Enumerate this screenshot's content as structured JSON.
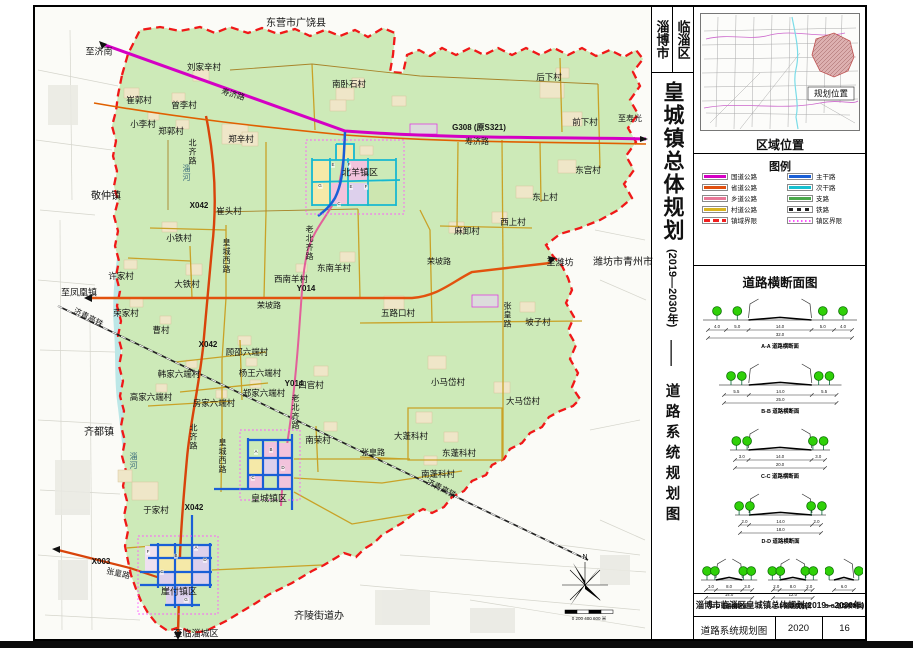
{
  "title_column": {
    "city": "淄博市",
    "district": "临淄区",
    "main": "皇城镇总体规划",
    "years": "(2019—2030年)",
    "dash": "——",
    "sub": "道路系统规划图"
  },
  "region_panel": {
    "caption": "区域位置",
    "marker": "规划位置"
  },
  "legend": {
    "title": "图例",
    "items": [
      {
        "label": "国道公路",
        "color": "#d400c4",
        "style": "solid",
        "col": 0
      },
      {
        "label": "省道公路",
        "color": "#e05010",
        "style": "solid",
        "col": 0
      },
      {
        "label": "乡道公路",
        "color": "#e87898",
        "style": "solid",
        "col": 0
      },
      {
        "label": "村道公路",
        "color": "#d9b420",
        "style": "solid",
        "col": 0
      },
      {
        "label": "镇域界限",
        "color": "#f02020",
        "style": "dash",
        "col": 0
      },
      {
        "label": "主干路",
        "color": "#1a5fd6",
        "style": "solid",
        "col": 1
      },
      {
        "label": "次干路",
        "color": "#17c0d0",
        "style": "solid",
        "col": 1
      },
      {
        "label": "支路",
        "color": "#4aa84a",
        "style": "solid",
        "col": 1
      },
      {
        "label": "铁路",
        "color": "#222222",
        "style": "rail",
        "col": 1
      },
      {
        "label": "镇区界限",
        "color": "#ff55ff",
        "style": "dot",
        "col": 1
      }
    ]
  },
  "cross_sections": {
    "title": "道路横断面图",
    "sections": [
      {
        "name": "A-A 道路横断面",
        "segments": [
          4.0,
          5.0,
          14.0,
          5.0,
          4.0
        ],
        "total": 32.0,
        "small": false
      },
      {
        "name": "B-B 道路横断面",
        "segments": [
          5.5,
          14.0,
          5.5
        ],
        "total": 25.0,
        "small": false
      },
      {
        "name": "C-C 道路横断面",
        "segments": [
          3.0,
          14.0,
          3.0
        ],
        "total": 20.0,
        "small": false
      },
      {
        "name": "D-D 道路横断面",
        "segments": [
          2.0,
          14.0,
          2.0
        ],
        "total": 18.0,
        "small": false
      },
      {
        "name": "E-E 道路横断面",
        "segments": [
          3.0,
          8.0,
          3.0
        ],
        "total": 14.0,
        "small": true
      },
      {
        "name": "F-F 道路横断面",
        "segments": [
          2.0,
          8.0,
          2.0
        ],
        "total": 12.0,
        "small": true
      },
      {
        "name": "G-G 道路横断面",
        "segments": [
          6.0
        ],
        "total": null,
        "small": true
      }
    ]
  },
  "title_block": {
    "project": "淄博市临淄区皇城镇总体规划(2019—2030年)",
    "drawing": "道路系统规划图",
    "year": "2020",
    "sheet": "16"
  },
  "map": {
    "north": "N",
    "scale": "0  200  400  600 米",
    "labels": [
      {
        "t": "东营市广饶县",
        "x": 296,
        "y": 24,
        "s": 10
      },
      {
        "t": "至济南",
        "x": 99,
        "y": 52,
        "s": 9
      },
      {
        "t": "刘家辛村",
        "x": 204,
        "y": 67
      },
      {
        "t": "南卧石村",
        "x": 349,
        "y": 84
      },
      {
        "t": "后下村",
        "x": 549,
        "y": 77
      },
      {
        "t": "前下村",
        "x": 585,
        "y": 122
      },
      {
        "t": "至寿光",
        "x": 630,
        "y": 119,
        "s": 8
      },
      {
        "t": "崔郭村",
        "x": 139,
        "y": 100
      },
      {
        "t": "曾李村",
        "x": 184,
        "y": 105
      },
      {
        "t": "寿济路",
        "x": 233,
        "y": 95,
        "r": 16,
        "s": 8
      },
      {
        "t": "小李村",
        "x": 143,
        "y": 124
      },
      {
        "t": "郑郭村",
        "x": 171,
        "y": 131
      },
      {
        "t": "郑辛村",
        "x": 241,
        "y": 139
      },
      {
        "t": "敬仲镇",
        "x": 106,
        "y": 197,
        "s": 10
      },
      {
        "t": "G308 (原S321)",
        "x": 479,
        "y": 128,
        "s": 8,
        "b": 1
      },
      {
        "t": "寿济路",
        "x": 477,
        "y": 142,
        "s": 8
      },
      {
        "t": "北羊镇区",
        "x": 360,
        "y": 173,
        "s": 9
      },
      {
        "t": "东宫村",
        "x": 588,
        "y": 170
      },
      {
        "t": "东上村",
        "x": 545,
        "y": 197
      },
      {
        "t": "西上村",
        "x": 513,
        "y": 222
      },
      {
        "t": "麻卸村",
        "x": 467,
        "y": 231
      },
      {
        "t": "东南羊村",
        "x": 334,
        "y": 268
      },
      {
        "t": "西南羊村",
        "x": 291,
        "y": 279
      },
      {
        "t": "Y014",
        "x": 306,
        "y": 289,
        "s": 8,
        "b": 1
      },
      {
        "t": "至潍坊",
        "x": 560,
        "y": 263,
        "s": 9
      },
      {
        "t": "潍坊市青州市",
        "x": 623,
        "y": 263,
        "s": 10
      },
      {
        "t": "崔头村",
        "x": 229,
        "y": 211
      },
      {
        "t": "X042",
        "x": 199,
        "y": 206,
        "s": 8,
        "b": 1
      },
      {
        "t": "小铁村",
        "x": 179,
        "y": 238
      },
      {
        "t": "许家村",
        "x": 121,
        "y": 276
      },
      {
        "t": "大铁村",
        "x": 187,
        "y": 284
      },
      {
        "t": "至凤凰镇",
        "x": 79,
        "y": 293,
        "s": 9
      },
      {
        "t": "荣坡路",
        "x": 269,
        "y": 306,
        "s": 8
      },
      {
        "t": "荣坡路",
        "x": 439,
        "y": 262,
        "s": 8
      },
      {
        "t": "荣家村",
        "x": 126,
        "y": 313
      },
      {
        "t": "曹村",
        "x": 161,
        "y": 330
      },
      {
        "t": "X042",
        "x": 208,
        "y": 345,
        "s": 8,
        "b": 1
      },
      {
        "t": "顾邵六端村",
        "x": 247,
        "y": 352
      },
      {
        "t": "杨王六端村",
        "x": 260,
        "y": 373
      },
      {
        "t": "韩家六端村",
        "x": 179,
        "y": 374
      },
      {
        "t": "高家六端村",
        "x": 151,
        "y": 397
      },
      {
        "t": "房家六端村",
        "x": 214,
        "y": 403
      },
      {
        "t": "郑家六端村",
        "x": 264,
        "y": 393
      },
      {
        "t": "Y014",
        "x": 294,
        "y": 384,
        "s": 8,
        "b": 1
      },
      {
        "t": "四官村",
        "x": 311,
        "y": 385
      },
      {
        "t": "五路口村",
        "x": 398,
        "y": 313
      },
      {
        "t": "坡子村",
        "x": 538,
        "y": 322
      },
      {
        "t": "小马岱村",
        "x": 448,
        "y": 382
      },
      {
        "t": "大马岱村",
        "x": 523,
        "y": 401
      },
      {
        "t": "齐都镇",
        "x": 99,
        "y": 433,
        "s": 10
      },
      {
        "t": "南荣村",
        "x": 318,
        "y": 440
      },
      {
        "t": "皇城镇区",
        "x": 269,
        "y": 499,
        "s": 9
      },
      {
        "t": "于家村",
        "x": 156,
        "y": 510
      },
      {
        "t": "X042",
        "x": 194,
        "y": 508,
        "s": 8,
        "b": 1
      },
      {
        "t": "X003",
        "x": 101,
        "y": 562,
        "s": 8,
        "b": 1
      },
      {
        "t": "张皇路",
        "x": 118,
        "y": 574,
        "r": 13,
        "s": 8
      },
      {
        "t": "崖付镇区",
        "x": 179,
        "y": 592,
        "s": 9
      },
      {
        "t": "齐陵街道办",
        "x": 319,
        "y": 617,
        "s": 10
      },
      {
        "t": "至临淄城区",
        "x": 196,
        "y": 634,
        "s": 9
      },
      {
        "t": "大蓬科村",
        "x": 411,
        "y": 436
      },
      {
        "t": "东蓬科村",
        "x": 459,
        "y": 453
      },
      {
        "t": "南蓬科村",
        "x": 438,
        "y": 474
      },
      {
        "t": "张皇路",
        "x": 373,
        "y": 453,
        "s": 8
      },
      {
        "t": "济青高铁",
        "x": 88,
        "y": 318,
        "r": 27,
        "s": 8
      },
      {
        "t": "济青高铁",
        "x": 441,
        "y": 489,
        "r": 27,
        "s": 8
      },
      {
        "t": "张皇路",
        "x": 507,
        "y": 315,
        "v": 1,
        "s": 8
      },
      {
        "t": "北齐路",
        "x": 192,
        "y": 152,
        "v": 1,
        "s": 8
      },
      {
        "t": "淄河",
        "x": 186,
        "y": 173,
        "v": 1,
        "s": 8,
        "c": "#3a6a7a"
      },
      {
        "t": "皇城西路",
        "x": 226,
        "y": 256,
        "v": 1,
        "s": 8
      },
      {
        "t": "老北齐路",
        "x": 309,
        "y": 243,
        "v": 1,
        "s": 8
      },
      {
        "t": "老北齐路",
        "x": 295,
        "y": 412,
        "v": 1,
        "s": 8
      },
      {
        "t": "北齐路",
        "x": 193,
        "y": 437,
        "v": 1,
        "s": 8
      },
      {
        "t": "皇城西路",
        "x": 222,
        "y": 456,
        "v": 1,
        "s": 8
      },
      {
        "t": "淄河",
        "x": 133,
        "y": 461,
        "v": 1,
        "s": 8,
        "c": "#3a6a7a"
      }
    ],
    "markers": [
      {
        "t": "E",
        "x": 333,
        "y": 165
      },
      {
        "t": "F",
        "x": 349,
        "y": 165
      },
      {
        "t": "G",
        "x": 320,
        "y": 186
      },
      {
        "t": "E",
        "x": 351,
        "y": 187
      },
      {
        "t": "F",
        "x": 366,
        "y": 187
      },
      {
        "t": "C",
        "x": 339,
        "y": 204
      },
      {
        "t": "A",
        "x": 256,
        "y": 452
      },
      {
        "t": "B",
        "x": 271,
        "y": 450
      },
      {
        "t": "C",
        "x": 253,
        "y": 478
      },
      {
        "t": "D",
        "x": 283,
        "y": 468
      },
      {
        "t": "A",
        "x": 196,
        "y": 548
      },
      {
        "t": "B",
        "x": 176,
        "y": 556
      },
      {
        "t": "C",
        "x": 162,
        "y": 572
      },
      {
        "t": "D",
        "x": 205,
        "y": 560
      },
      {
        "t": "F",
        "x": 148,
        "y": 552
      },
      {
        "t": "G",
        "x": 186,
        "y": 600
      }
    ]
  }
}
